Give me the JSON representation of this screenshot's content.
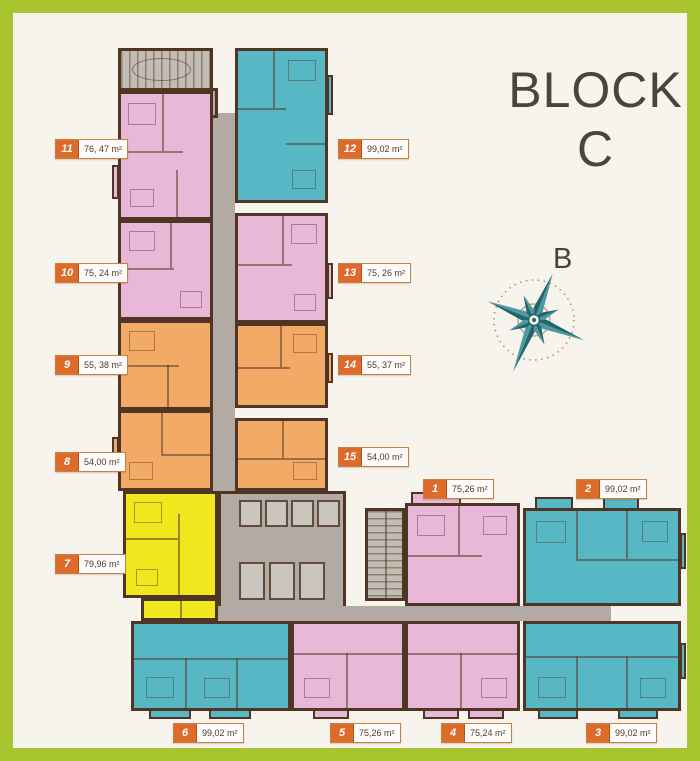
{
  "title": {
    "line1": "BLOCK",
    "line2": "C"
  },
  "compass": {
    "label": "B"
  },
  "colors": {
    "frame_green": "#a8c42f",
    "background": "#f7f4ee",
    "wall_brown": "#4f3523",
    "unit_pink": "#e9b7d8",
    "unit_cyan": "#57b7c5",
    "unit_orange": "#f2aa66",
    "unit_yellow": "#f0e71c",
    "corridor_grey": "#b2aaa3",
    "label_orange": "#dd6b2b",
    "title_grey": "#4a443c",
    "compass_teal": "#20666b"
  },
  "units": [
    {
      "id": "1",
      "area": "75,26 m²",
      "color": "pink"
    },
    {
      "id": "2",
      "area": "99,02 m²",
      "color": "cyan"
    },
    {
      "id": "3",
      "area": "99,02 m²",
      "color": "cyan"
    },
    {
      "id": "4",
      "area": "75,24 m²",
      "color": "pink"
    },
    {
      "id": "5",
      "area": "75,26 m²",
      "color": "pink"
    },
    {
      "id": "6",
      "area": "99,02 m²",
      "color": "cyan"
    },
    {
      "id": "7",
      "area": "79,96 m²",
      "color": "yellow"
    },
    {
      "id": "8",
      "area": "54,00 m²",
      "color": "orange"
    },
    {
      "id": "9",
      "area": "55, 38 m²",
      "color": "orange"
    },
    {
      "id": "10",
      "area": "75, 24 m²",
      "color": "pink"
    },
    {
      "id": "11",
      "area": "76, 47 m²",
      "color": "pink"
    },
    {
      "id": "12",
      "area": "99,02 m²",
      "color": "cyan"
    },
    {
      "id": "13",
      "area": "75, 26 m²",
      "color": "pink"
    },
    {
      "id": "14",
      "area": "55, 37 m²",
      "color": "orange"
    },
    {
      "id": "15",
      "area": "54,00 m²",
      "color": "orange"
    }
  ]
}
